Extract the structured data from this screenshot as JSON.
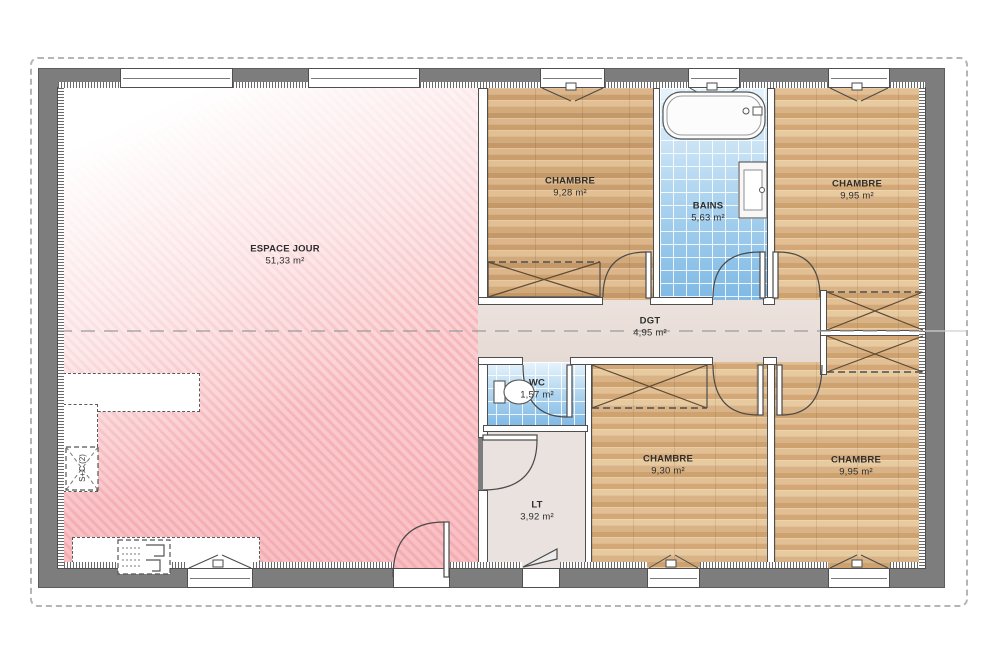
{
  "plan": {
    "rooms": [
      {
        "id": "espace-jour",
        "name": "ESPACE JOUR",
        "area": "51,33 m²"
      },
      {
        "id": "chambre-1",
        "name": "CHAMBRE",
        "area": "9,28 m²"
      },
      {
        "id": "bains",
        "name": "BAINS",
        "area": "5,63 m²"
      },
      {
        "id": "chambre-2",
        "name": "CHAMBRE",
        "area": "9,95 m²"
      },
      {
        "id": "dgt",
        "name": "DGT",
        "area": "4,95 m²"
      },
      {
        "id": "wc",
        "name": "WC",
        "area": "1,57 m²"
      },
      {
        "id": "chambre-3",
        "name": "CHAMBRE",
        "area": "9,30 m²"
      },
      {
        "id": "lt",
        "name": "LT",
        "area": "3,92 m²"
      },
      {
        "id": "chambre-4",
        "name": "CHAMBRE",
        "area": "9,95 m²"
      }
    ],
    "annotations": {
      "corner_marker": "S+C (2)"
    },
    "colors": {
      "exterior_wall": "#7d7d7d",
      "living_pink": "#f5b7bb",
      "wood_floor": "#d1a573",
      "tile_blue": "#9ecbed",
      "corridor_greige": "#e8dcd7"
    }
  }
}
